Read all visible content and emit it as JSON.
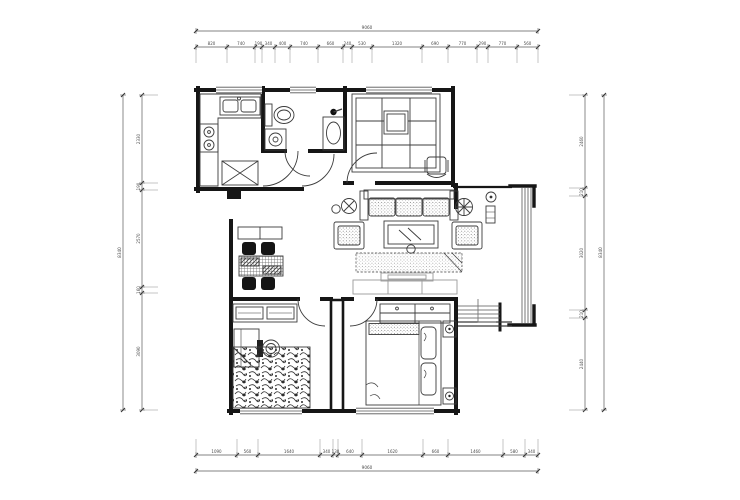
{
  "canvas": {
    "width": 740,
    "height": 500,
    "background": "#ffffff"
  },
  "drawing": {
    "description": "Two-bedroom apartment CAD floor plan with furniture and four dimension chains",
    "wall_color": "#161616",
    "furniture_color": "#3c3c3c",
    "light_line_color": "#999999",
    "dim_line_color": "#5a5a5a",
    "dim_text_color": "#4a4a4a"
  },
  "dimensions": {
    "top": {
      "orientation": "h",
      "seg_line": 47,
      "total_line": 31,
      "start": 196,
      "end": 538,
      "ext": 16,
      "ticks": [
        196,
        227,
        255,
        262,
        275,
        290,
        318,
        343,
        352,
        372,
        422,
        448,
        477,
        488,
        517,
        538
      ],
      "labels": [
        "820",
        "740",
        "190",
        "340",
        "400",
        "740",
        "660",
        "240",
        "530",
        "1320",
        "690",
        "770",
        "290",
        "770",
        "560"
      ],
      "total": "9060"
    },
    "bottom": {
      "orientation": "h",
      "seg_line": 455,
      "total_line": 471,
      "start": 196,
      "end": 538,
      "ext": -16,
      "ticks": [
        196,
        237,
        258,
        320,
        333,
        338,
        362,
        423,
        448,
        503,
        525,
        538
      ],
      "labels": [
        "1090",
        "560",
        "1640",
        "340",
        "130",
        "640",
        "1620",
        "660",
        "1460",
        "580",
        "340"
      ],
      "total": "9060"
    },
    "left": {
      "orientation": "v",
      "seg_line": 142,
      "total_line": 123,
      "start": 95,
      "end": 410,
      "ext": 16,
      "ticks": [
        95,
        183,
        190,
        287,
        293,
        410
      ],
      "labels": [
        "2330",
        "190",
        "2570",
        "160",
        "3090"
      ],
      "total": "8340"
    },
    "right": {
      "orientation": "v",
      "seg_line": 585,
      "total_line": 604,
      "start": 95,
      "end": 410,
      "ext": -16,
      "ticks": [
        95,
        188,
        196,
        310,
        318,
        410
      ],
      "labels": [
        "2460",
        "210",
        "3020",
        "210",
        "2440"
      ],
      "total": "8340"
    }
  }
}
